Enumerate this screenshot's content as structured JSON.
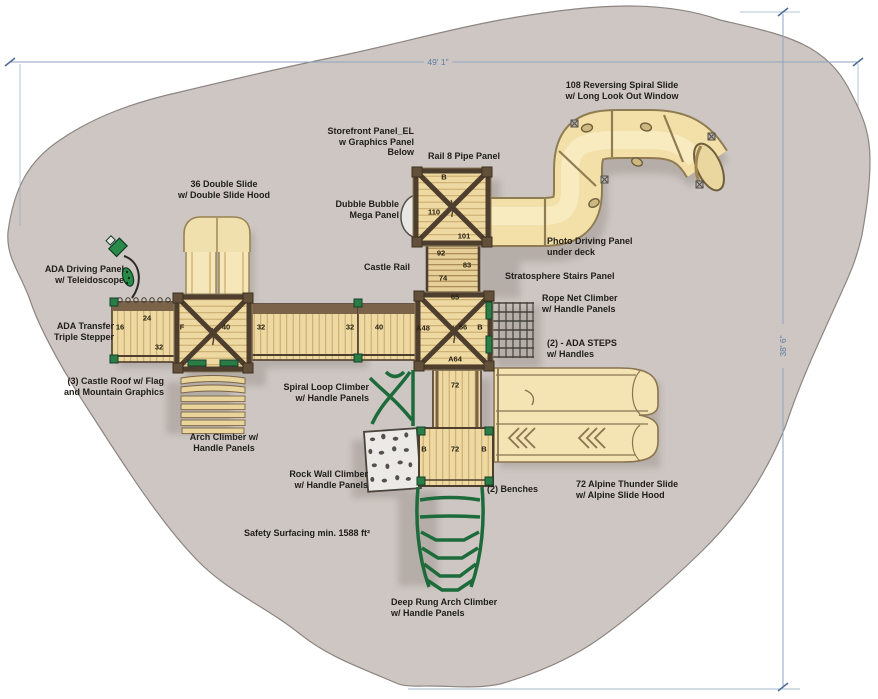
{
  "dimensions": {
    "width_label": "49' 1\"",
    "height_label": "38' 6\""
  },
  "labels": {
    "spiral_slide_108": "108 Reversing Spiral Slide\nw/ Long Look Out Window",
    "storefront_panel": "Storefront Panel_EL\nw Graphics Panel\nBelow",
    "rail_8_pipe_panel": "Rail 8 Pipe Panel",
    "double_slide_36": "36 Double Slide\nw/ Double Slide Hood",
    "dubble_bubble": "Dubble Bubble\nMega Panel",
    "photo_driving_panel": "Photo Driving Panel\nunder deck",
    "castle_rail": "Castle Rail",
    "stratosphere_stairs": "Stratosphere Stairs Panel",
    "ada_driving_panel": "ADA Driving Panel\nw/ Teleidoscope",
    "rope_net_climber": "Rope Net Climber\nw/ Handle Panels",
    "ada_transfer": "ADA Transfer\nTriple Stepper",
    "ada_steps": "(2) - ADA STEPS\nw/ Handles",
    "castle_roof": "(3) Castle Roof w/ Flag\nand Mountain Graphics",
    "spiral_loop_climber": "Spiral Loop Climber\nw/ Handle Panels",
    "arch_climber": "Arch Climber w/\nHandle Panels",
    "rock_wall_climber": "Rock Wall Climber\nw/ Handle Panels",
    "benches": "(2) Benches",
    "alpine_slide_72": "72 Alpine Thunder Slide\nw/ Alpine Slide Hood",
    "safety_surfacing": "Safety Surfacing min. 1588 ft²",
    "deep_rung_arch_climber": "Deep Rung Arch Climber\nw/ Handle Panels"
  },
  "deck_numbers": {
    "b_roof": "B",
    "n110": "110",
    "n101": "101",
    "n92": "92",
    "n83": "83",
    "n74": "74",
    "n65": "65",
    "a48": "A48",
    "n56": "56",
    "b_deck": "B",
    "a64": "A64",
    "n72_upper": "72",
    "b_left": "B",
    "n72_lower": "72",
    "b_right": "B",
    "n16": "16",
    "n24": "24",
    "n32_ramp": "32",
    "f_panel": "F",
    "n40_tower": "40",
    "n32_bridge": "32",
    "n32_bridge2": "32",
    "n40_walkway": "40"
  },
  "colors": {
    "surfacing": "#cdc6c2",
    "deck_tan": "#edd9a1",
    "slide_yellow": "#f4e4b4",
    "frame_brown": "#4e3e2d",
    "accent_green": "#2a7d45",
    "dimension_blue": "#5d7da6"
  }
}
